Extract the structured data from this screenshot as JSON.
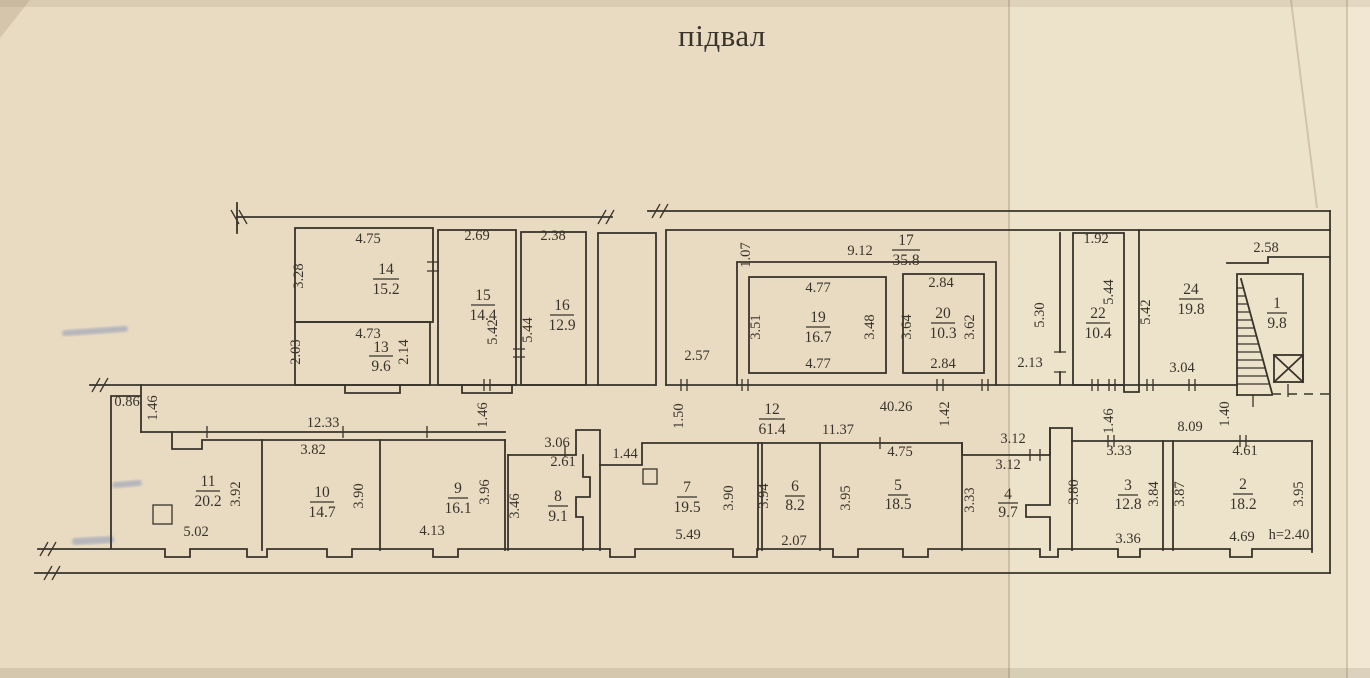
{
  "title": "підвал",
  "colors": {
    "paper": "#e8dbc1",
    "ink": "#39342b",
    "pen_mark": "#5a6fb5"
  },
  "rooms": {
    "r1": {
      "number": "1",
      "area": "9.8"
    },
    "r2": {
      "number": "2",
      "area": "18.2"
    },
    "r3": {
      "number": "3",
      "area": "12.8"
    },
    "r4": {
      "number": "4",
      "area": "9.7"
    },
    "r5": {
      "number": "5",
      "area": "18.5"
    },
    "r6": {
      "number": "6",
      "area": "8.2"
    },
    "r7": {
      "number": "7",
      "area": "19.5"
    },
    "r8": {
      "number": "8",
      "area": "9.1"
    },
    "r9": {
      "number": "9",
      "area": "16.1"
    },
    "r10": {
      "number": "10",
      "area": "14.7"
    },
    "r11": {
      "number": "11",
      "area": "20.2"
    },
    "r12": {
      "number": "12",
      "area": "61.4"
    },
    "r13": {
      "number": "13",
      "area": "9.6"
    },
    "r14": {
      "number": "14",
      "area": "15.2"
    },
    "r15": {
      "number": "15",
      "area": "14.4"
    },
    "r16": {
      "number": "16",
      "area": "12.9"
    },
    "r17": {
      "number": "17",
      "area": "35.8"
    },
    "r19": {
      "number": "19",
      "area": "16.7"
    },
    "r20": {
      "number": "20",
      "area": "10.3"
    },
    "r22": {
      "number": "22",
      "area": "10.4"
    },
    "r24": {
      "number": "24",
      "area": "19.8"
    }
  },
  "dims": {
    "r14_top": "4.75",
    "r14_left": "3.28",
    "r13_top": "4.73",
    "r13_left": "2.03",
    "r13_right": "2.14",
    "r15_top": "2.69",
    "r15_right": "5.42",
    "r16_top": "2.38",
    "r16_left": "5.44",
    "r17_width": "9.12",
    "r17_gap": "1.07",
    "hall_left": "2.57",
    "hall_right": "2.13",
    "r19_top": "4.77",
    "r19_left": "3.51",
    "r19_right": "3.48",
    "r19_bottom": "4.77",
    "r20_top": "2.84",
    "r20_left": "3.64",
    "r20_right": "3.62",
    "r20_bottom": "2.84",
    "hall22_width": "5.30",
    "r22_top": "1.92",
    "r22_right": "5.44",
    "r24_left": "5.42",
    "r24_bottom": "3.04",
    "r1_top": "2.58",
    "c_086": "0.86",
    "c_146a": "1.46",
    "c_1233": "12.33",
    "c_146b": "1.46",
    "c_306": "3.06",
    "c_261": "2.61",
    "c_144": "1.44",
    "c_150": "1.50",
    "c_1137": "11.37",
    "c_4026": "40.26",
    "c_142": "1.42",
    "c_312a": "3.12",
    "c_312b": "3.12",
    "c_146c": "1.46",
    "c_809": "8.09",
    "c_140": "1.40",
    "r11_right": "3.92",
    "r11_bottom": "5.02",
    "r10_top": "3.82",
    "r10_right": "3.90",
    "r9_right": "3.96",
    "r9_bottom": "4.13",
    "r8_left": "3.46",
    "r7_right": "3.90",
    "r7_bottom": "5.49",
    "r6_left": "3.94",
    "r6_bottom": "2.07",
    "r5_top": "4.75",
    "r5_left": "3.95",
    "r4_left": "3.33",
    "r3_top": "3.33",
    "r3_left": "3.80",
    "r3_right": "3.84",
    "r3_bottom": "3.36",
    "r2_top": "4.61",
    "r2_left": "3.87",
    "r2_right": "3.95",
    "r2_bottom": "4.69",
    "ceiling_height": "h=2.40"
  }
}
